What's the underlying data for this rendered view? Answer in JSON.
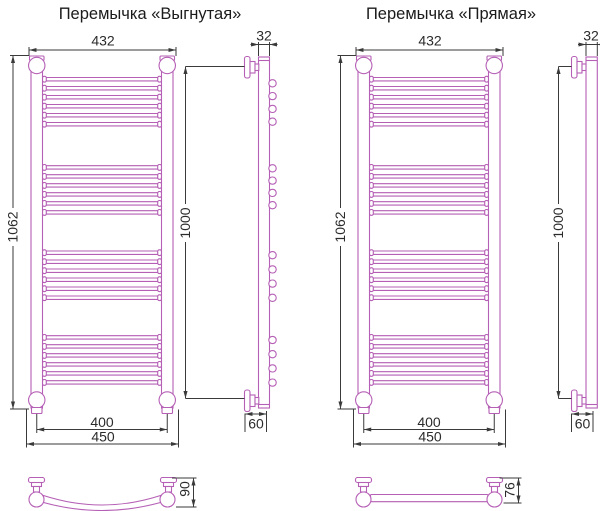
{
  "drawings": [
    {
      "id": "curved",
      "title": "Перемычка «Выгнутая»",
      "dimensions": {
        "top_width": "432",
        "overall_height": "1062",
        "axis_width": "400",
        "overall_width": "450",
        "pipe_width": "32",
        "mounting_height": "1000",
        "wall_distance": "60",
        "crossbar_depth": "90"
      }
    },
    {
      "id": "straight",
      "title": "Перемычка «Прямая»",
      "dimensions": {
        "top_width": "432",
        "overall_height": "1062",
        "axis_width": "400",
        "overall_width": "450",
        "pipe_width": "32",
        "mounting_height": "1000",
        "wall_distance": "60",
        "crossbar_depth": "76"
      }
    }
  ],
  "colors": {
    "drawing_line": "#b55fb5",
    "dimension_line": "#3a3a3a"
  }
}
